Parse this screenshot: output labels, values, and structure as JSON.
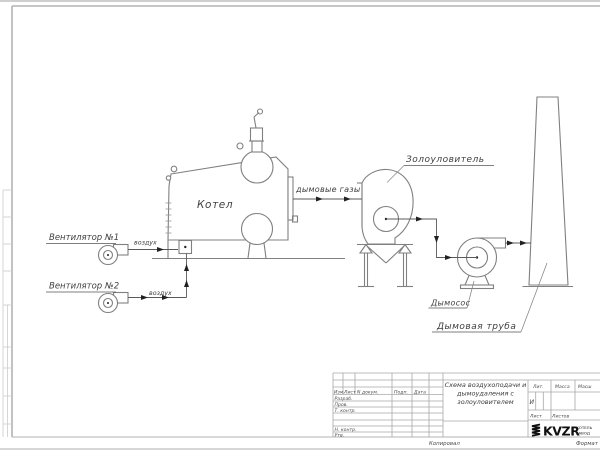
{
  "diagram": {
    "boiler_label": "Котел",
    "fan1_label": "Вентилятор №1",
    "fan2_label": "Вентилятор №2",
    "fan1_air_label": "воздух",
    "fan2_air_label": "воздух",
    "flue_gas_label": "дымовые газы",
    "ash_collector_label": "Золоуловитель",
    "smoke_exhauster_label": "Дымосос",
    "chimney_label": "Дымовая труба"
  },
  "title_block": {
    "doc_title_line1": "Схема воздухоподачи и",
    "doc_title_line2": "дымоудаления с",
    "doc_title_line3": "золоуловителем",
    "col_izm": "Изм.",
    "col_list": "Лист",
    "col_ndokum": "N докум.",
    "col_podp": "Подп.",
    "col_data": "Дата",
    "row_razrab": "Разраб.",
    "row_prov": "Пров.",
    "row_tkontr": "Т. контр.",
    "row_nkontr": "Н. контр.",
    "row_utv": "Утв.",
    "lit_label": "Лит.",
    "lit_value": "И",
    "massa_label": "Масса",
    "masshtab_label": "Масш",
    "list_label": "Лист",
    "listov_label": "Листов",
    "logo_text": "KVZR",
    "logo_sub_line1": "КОТЕЛЬ",
    "logo_sub_line2": "ЗАВОД",
    "kopiroval_label": "Копировал",
    "format_label": "Формат"
  },
  "colors": {
    "line": "#808080",
    "flow_line": "#5a5a5a",
    "frame": "#b3b3b3",
    "text": "#3f3f3f",
    "arrow": "#222222",
    "logo": "#101010"
  }
}
